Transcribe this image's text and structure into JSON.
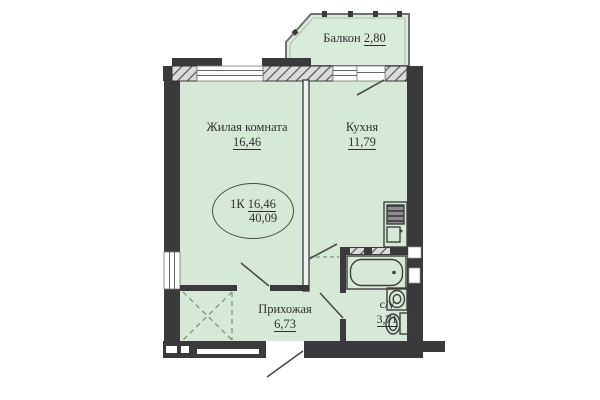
{
  "rooms": {
    "balcony": {
      "name": "Балкон",
      "area": "2,80"
    },
    "living_room": {
      "name": "Жилая комната",
      "area": "16,46"
    },
    "kitchen": {
      "name": "Кухня",
      "area": "11,79"
    },
    "hallway": {
      "name": "Прихожая",
      "area": "6,73"
    },
    "bathroom": {
      "name": "с/у",
      "area": "3,71"
    }
  },
  "stamp": {
    "type": "1К",
    "living_area": "16,46",
    "total_area": "40,09"
  },
  "colors": {
    "floor_fill": "#d6e9d7",
    "wall": "#3a3a3c",
    "text": "#2e2e2e"
  }
}
